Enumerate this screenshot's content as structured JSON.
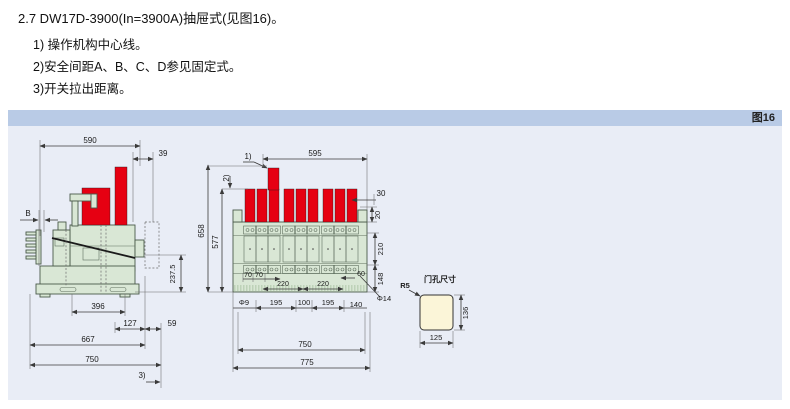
{
  "document": {
    "heading": "2.7 DW17D-3900(In=3900A)抽屉式(见图16)。",
    "notes": [
      "1) 操作机构中心线。",
      "2)安全间距A、B、C、D参见固定式。",
      "3)开关拉出距离。"
    ]
  },
  "figure": {
    "caption": "图16",
    "colors": {
      "panel_bg": "#e9edf6",
      "header_bg": "#b9cbe6",
      "busbar_red": "#e60012",
      "body_green": "#d9e7d5",
      "door_cream": "#fbf5d8",
      "line": "#3a3a3a"
    },
    "side_view": {
      "width_top": "590",
      "offset_top": "39",
      "gap_b": "B",
      "height_ref": "237.5",
      "dim_396": "396",
      "dim_127": "127",
      "dim_59": "59",
      "dim_667": "667",
      "dim_750": "750",
      "pullout_note": "3)"
    },
    "front_view": {
      "note_1": "1)",
      "note_2": "2)",
      "width_top": "595",
      "bar_width": "30",
      "bar_step": "20",
      "height_outer": "658",
      "height_inner": "577",
      "mid_height": "210",
      "base_height": "148",
      "pole_70a": "70",
      "pole_70b": "70",
      "phase_220a": "220",
      "phase_220b": "220",
      "end_60": "60",
      "hole_phi9": "Φ9",
      "span_195a": "195",
      "span_100": "100",
      "span_195b": "195",
      "span_140": "140",
      "hole_phi14": "Φ14",
      "width_750": "750",
      "width_775": "775"
    },
    "door_hole": {
      "title": "门孔尺寸",
      "corner_radius": "R5",
      "height": "136",
      "width": "125"
    }
  }
}
